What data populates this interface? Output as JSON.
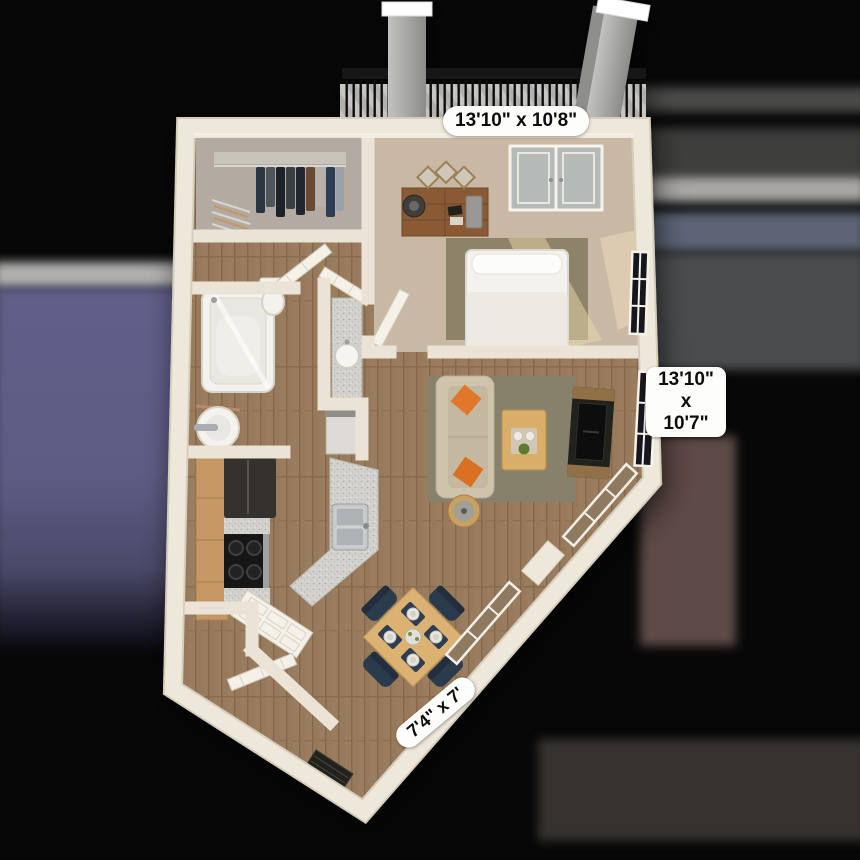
{
  "scene": {
    "type": "3d-apartment-floor-plan-render",
    "rooms_visible": [
      "bedroom",
      "closet",
      "bathroom",
      "kitchen",
      "living-room",
      "dining-area",
      "entry",
      "balcony"
    ]
  },
  "dimension_labels": {
    "bedroom_balcony": "13'10\" x 10'8\"",
    "living_line1": "13'10\"",
    "living_line2": "x",
    "living_line3": "10'7\"",
    "patio": "7'4\" x 7'"
  },
  "palette": {
    "backdrop_black": "#070707",
    "backdrop_purple": "#5d5c84",
    "backdrop_gray_band": "#b2b0ae",
    "backdrop_blue_gray": "#5c6475",
    "backdrop_mauve": "#5e4a47",
    "backdrop_bottom_band": "#36332e",
    "wall_cream": "#ece6d8",
    "wood_floor": "#97795b",
    "carpet_beige": "#c9b9a4",
    "closet_carpet_gray": "#b3aba1",
    "rug_olive": "#87806a",
    "sofa_tan": "#cfc3ac",
    "pillow_orange": "#e0772b",
    "dining_table_wood": "#dcb272",
    "chair_navy": "#2e3c50",
    "granite_gray": "#d3d1cc",
    "appliance_black": "#1e1d1b",
    "label_bg": "#fdfdfb",
    "label_text": "#0d0d0d"
  }
}
